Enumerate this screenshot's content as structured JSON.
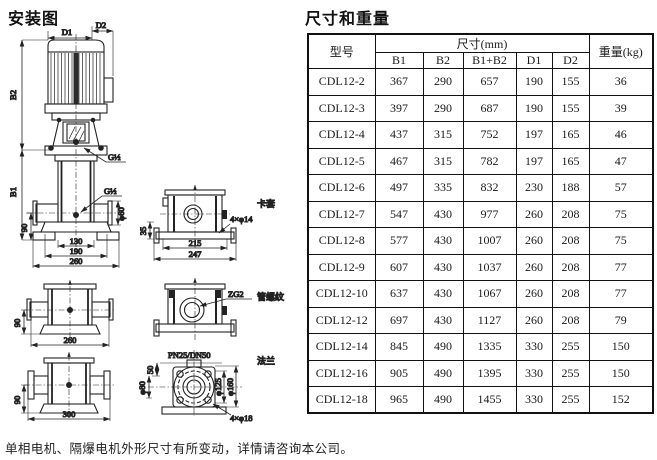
{
  "titles": {
    "installation": "安装图",
    "dimensions": "尺寸和重量"
  },
  "footnote": "单相电机、隔爆电机外形尺寸有所变动，详情请咨询本公司。",
  "table": {
    "col_model": "型号",
    "col_size_group": "尺寸(mm)",
    "size_columns": [
      "B1",
      "B2",
      "B1+B2",
      "D1",
      "D2"
    ],
    "col_weight": "重量(kg)",
    "rows": [
      [
        "CDL12-2",
        "367",
        "290",
        "657",
        "190",
        "155",
        "36"
      ],
      [
        "CDL12-3",
        "397",
        "290",
        "687",
        "190",
        "155",
        "39"
      ],
      [
        "CDL12-4",
        "437",
        "315",
        "752",
        "197",
        "165",
        "46"
      ],
      [
        "CDL12-5",
        "467",
        "315",
        "782",
        "197",
        "165",
        "47"
      ],
      [
        "CDL12-6",
        "497",
        "335",
        "832",
        "230",
        "188",
        "57"
      ],
      [
        "CDL12-7",
        "547",
        "430",
        "977",
        "260",
        "208",
        "75"
      ],
      [
        "CDL12-8",
        "577",
        "430",
        "1007",
        "260",
        "208",
        "75"
      ],
      [
        "CDL12-9",
        "607",
        "430",
        "1037",
        "260",
        "208",
        "77"
      ],
      [
        "CDL12-10",
        "637",
        "430",
        "1067",
        "260",
        "208",
        "77"
      ],
      [
        "CDL12-12",
        "697",
        "430",
        "1127",
        "260",
        "208",
        "79"
      ],
      [
        "CDL12-14",
        "845",
        "490",
        "1335",
        "330",
        "255",
        "150"
      ],
      [
        "CDL12-16",
        "905",
        "490",
        "1395",
        "330",
        "255",
        "150"
      ],
      [
        "CDL12-18",
        "965",
        "490",
        "1455",
        "330",
        "255",
        "152"
      ]
    ]
  },
  "drawing": {
    "main": {
      "d1": "D1",
      "d2": "D2",
      "b2": "B2",
      "b1": "B1",
      "g_half_upper": "G½",
      "g_half_lower": "G½",
      "dim_90": "90",
      "dim_130": "130",
      "dim_190": "190",
      "dim_260": "260",
      "dia_60": "φ60"
    },
    "ferrule": {
      "name": "卡套",
      "holes": "4×φ14",
      "dim_35": "35",
      "dim_215": "215",
      "dim_247": "247"
    },
    "thread_side": {
      "dim_90": "90",
      "dim_260": "260"
    },
    "thread": {
      "code": "ZG2",
      "name": "管螺纹"
    },
    "flange_side": {
      "dim_90": "90",
      "dim_300": "300"
    },
    "flange": {
      "name": "法兰",
      "spec": "PN25/DN50",
      "dim_50": "50",
      "dia_80": "φ80",
      "dia_125": "φ125",
      "dia_160": "φ160",
      "holes": "4×φ18"
    }
  },
  "colors": {
    "ink": "#1a1a1a",
    "paper": "#ffffff"
  }
}
